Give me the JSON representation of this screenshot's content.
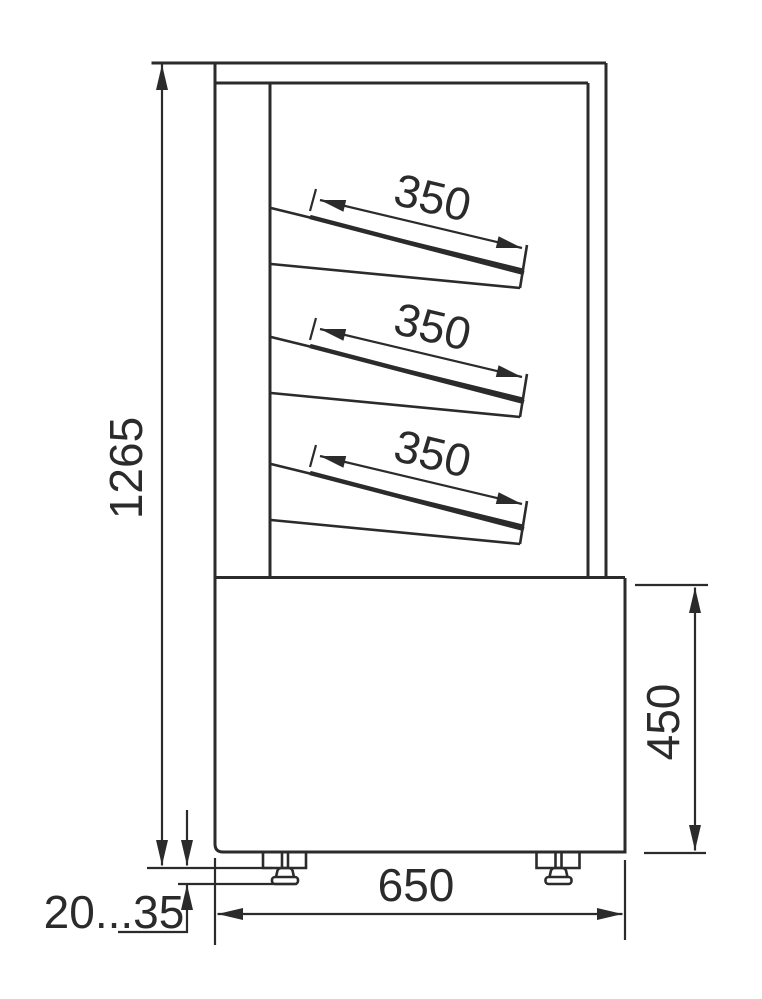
{
  "drawing": {
    "background_color": "#ffffff",
    "line_color": "#2b2b2b",
    "dimension_labels": {
      "overall_height": "1265",
      "shelf_depths": [
        "350",
        "350",
        "350"
      ],
      "base_height": "450",
      "base_depth": "650",
      "leg_height_range": "20...35"
    }
  }
}
